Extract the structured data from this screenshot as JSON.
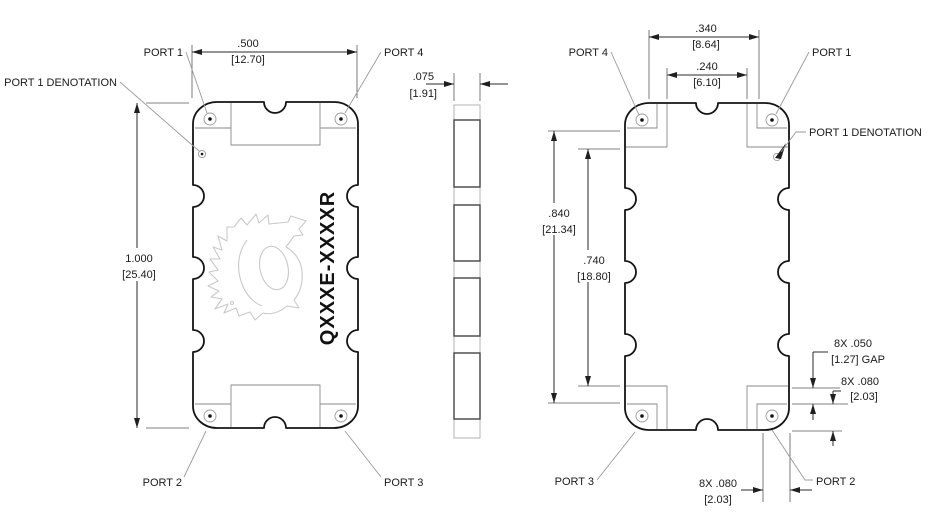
{
  "views": {
    "top": {
      "port1": "PORT 1",
      "port2": "PORT 2",
      "port3": "PORT 3",
      "port4": "PORT 4",
      "port1_denotation": "PORT 1 DENOTATION",
      "part_number": "QXXXE-XXXXR",
      "dim_width_in": ".500",
      "dim_width_mm": "[12.70]",
      "dim_height_in": "1.000",
      "dim_height_mm": "[25.40]"
    },
    "side": {
      "dim_thickness_in": ".075",
      "dim_thickness_mm": "[1.91]"
    },
    "bottom": {
      "port1": "PORT 1",
      "port2": "PORT 2",
      "port3": "PORT 3",
      "port4": "PORT 4",
      "port1_denotation": "PORT 1 DENOTATION",
      "dim_pad_span_in": ".340",
      "dim_pad_span_mm": "[8.64]",
      "dim_inner_span_in": ".240",
      "dim_inner_span_mm": "[6.10]",
      "dim_outer_height_in": ".840",
      "dim_outer_height_mm": "[21.34]",
      "dim_inner_height_in": ".740",
      "dim_inner_height_mm": "[18.80]",
      "dim_gap_in": "8X .050",
      "dim_gap_mm": "[1.27] GAP",
      "dim_pad_side_in": "8X .080",
      "dim_pad_side_mm": "[2.03]",
      "dim_pad_bottom_in": "8X .080",
      "dim_pad_bottom_mm": "[2.03]"
    }
  }
}
